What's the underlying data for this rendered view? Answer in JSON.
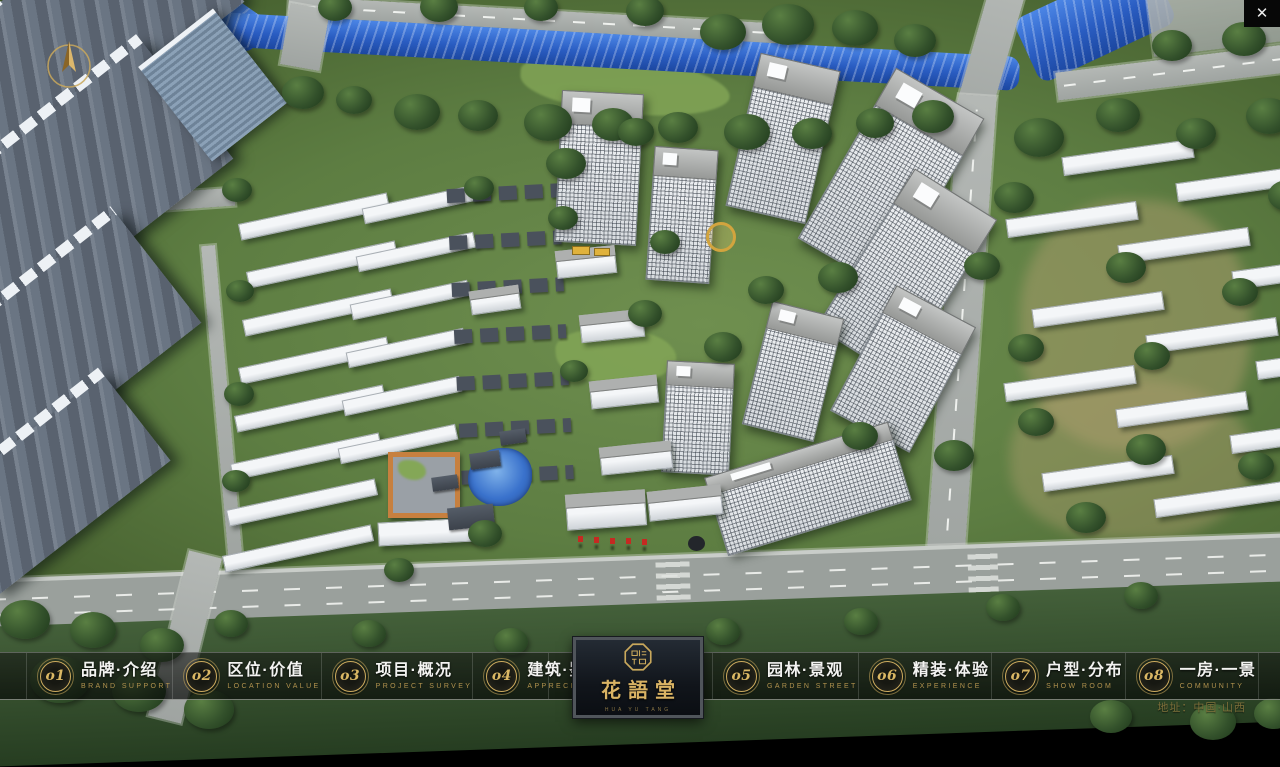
{
  "window": {
    "close_icon": "✕"
  },
  "nav": {
    "items": [
      {
        "num": "o1",
        "title": "品牌·介绍",
        "subtitle": "BRAND SUPPORT"
      },
      {
        "num": "o2",
        "title": "区位·价值",
        "subtitle": "LOCATION VALUE"
      },
      {
        "num": "o3",
        "title": "项目·概况",
        "subtitle": "PROJECT SURVEY"
      },
      {
        "num": "o4",
        "title": "建筑·鉴赏",
        "subtitle": "APPRECIATION"
      },
      {
        "num": "o5",
        "title": "园林·景观",
        "subtitle": "GARDEN STREET"
      },
      {
        "num": "o6",
        "title": "精装·体验",
        "subtitle": "EXPERIENCE"
      },
      {
        "num": "o7",
        "title": "户型·分布",
        "subtitle": "SHOW ROOM"
      },
      {
        "num": "o8",
        "title": "一房·一景",
        "subtitle": "COMMUNITY"
      }
    ]
  },
  "logo": {
    "name": "花語堂",
    "tagline": "HUA YU TANG"
  },
  "footer": {
    "address": "地址：中国·山西"
  },
  "theme": {
    "gold": "#c9a85c",
    "nav_background": "rgba(12,14,12,0.65)"
  }
}
